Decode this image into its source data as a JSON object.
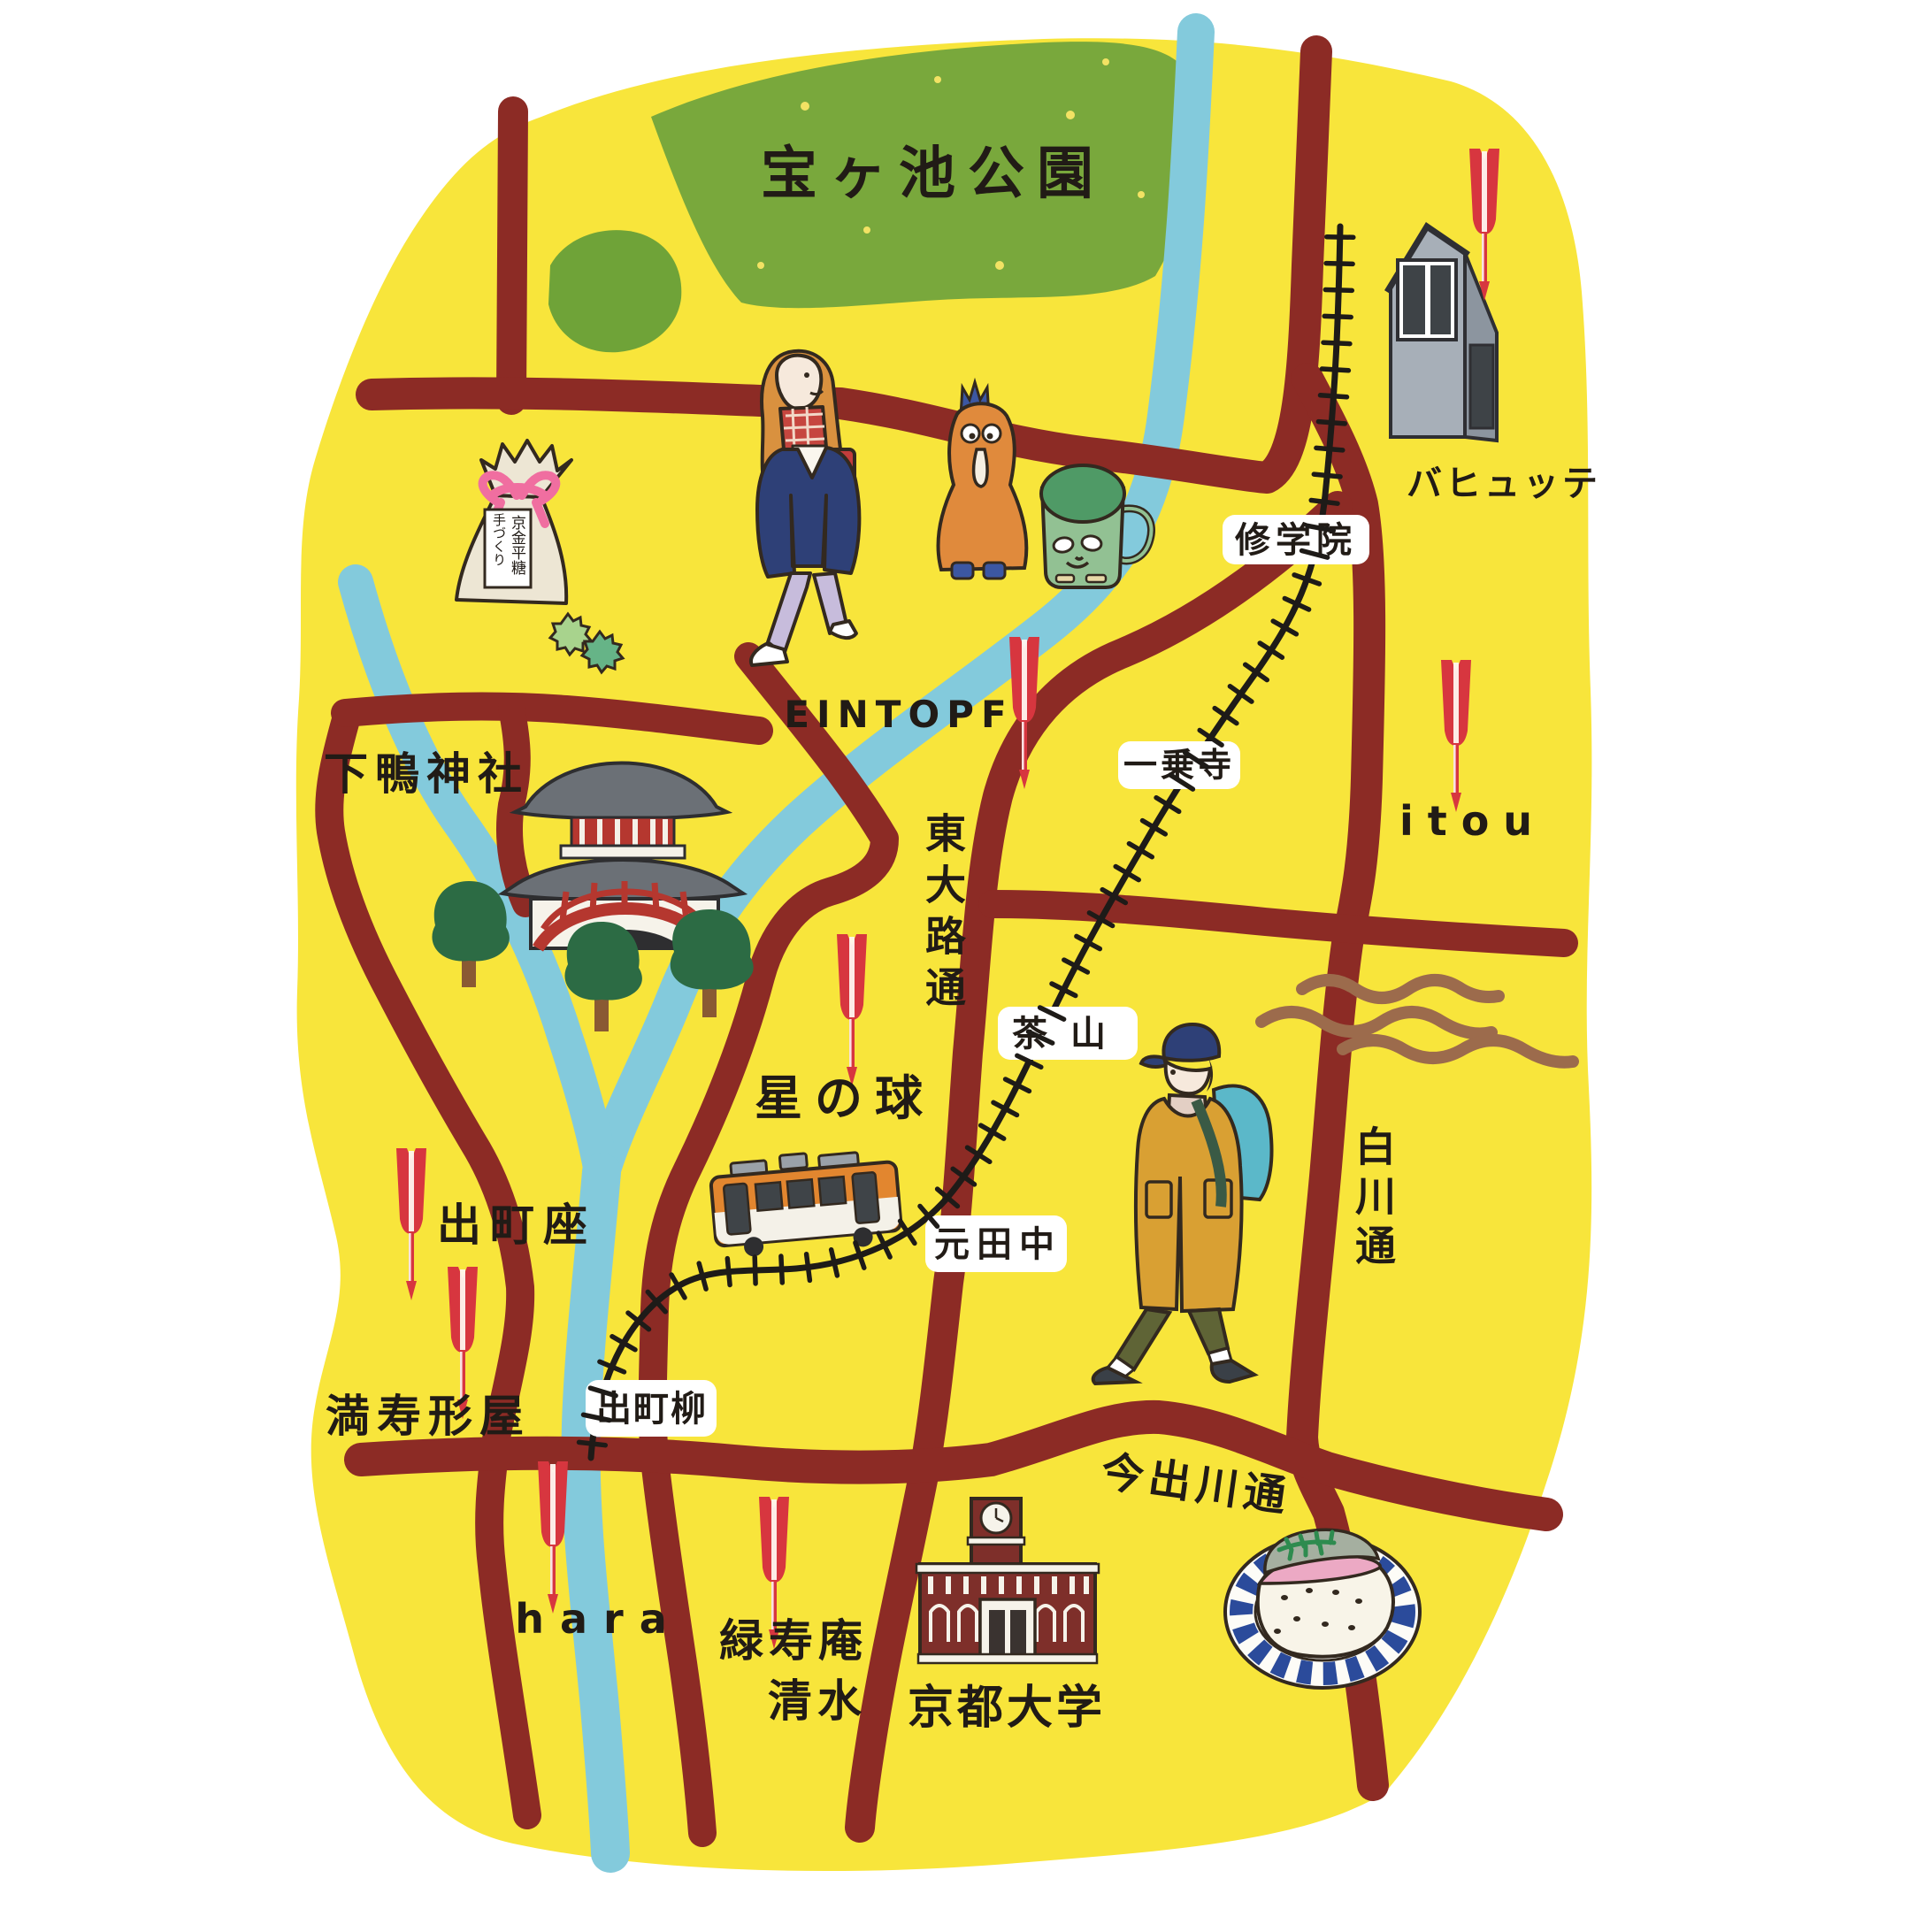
{
  "colors": {
    "background": "#ffffff",
    "land_yellow": "#f8e53b",
    "park_green": "#79a83c",
    "road_maroon": "#8c2b25",
    "river_blue": "#83cadc",
    "railway_black": "#1e1b18",
    "marker_red": "#d7363f",
    "wave_brown": "#9c6b4c",
    "text_ink": "#211b16"
  },
  "labels": {
    "park": "宝ヶ池公園",
    "bahyutte": "バヒュッテ",
    "eintopf": "EINTOPF",
    "itou": "itou",
    "shimogamo_shrine": "下鴨神社",
    "higashioji_dori": "東大路通",
    "hoshi_no_tama": "星の球",
    "shirakawa_dori": "白川通",
    "demachiza": "出町座",
    "masugataya": "満寿形屋",
    "imadegawa_dori": "今出川通",
    "hara": "hara",
    "ryokujuan_line1": "緑寿庵",
    "ryokujuan_line2": "清水",
    "kyoto_university": "京都大学"
  },
  "stations": {
    "shugakuin": "修学院",
    "ichijoji": "一乗寺",
    "chayama": "茶山",
    "mototanaka": "元田中",
    "demachiyanagi": "出町柳"
  },
  "illustrations": {
    "candy_bag_label_line1": "手づくり",
    "candy_bag_label_line2": "京金平糖",
    "names": [
      "konpeito-candy-bag",
      "walking-woman",
      "chicken-bird",
      "green-mug",
      "hut-building",
      "shimogamo-shrine-gate",
      "red-bridge",
      "trees",
      "eizan-train",
      "coat-person",
      "kyoto-university-building",
      "saba-sushi-plate"
    ]
  },
  "icons": {
    "marker": "red-dart-pin",
    "marker_count": 8
  }
}
